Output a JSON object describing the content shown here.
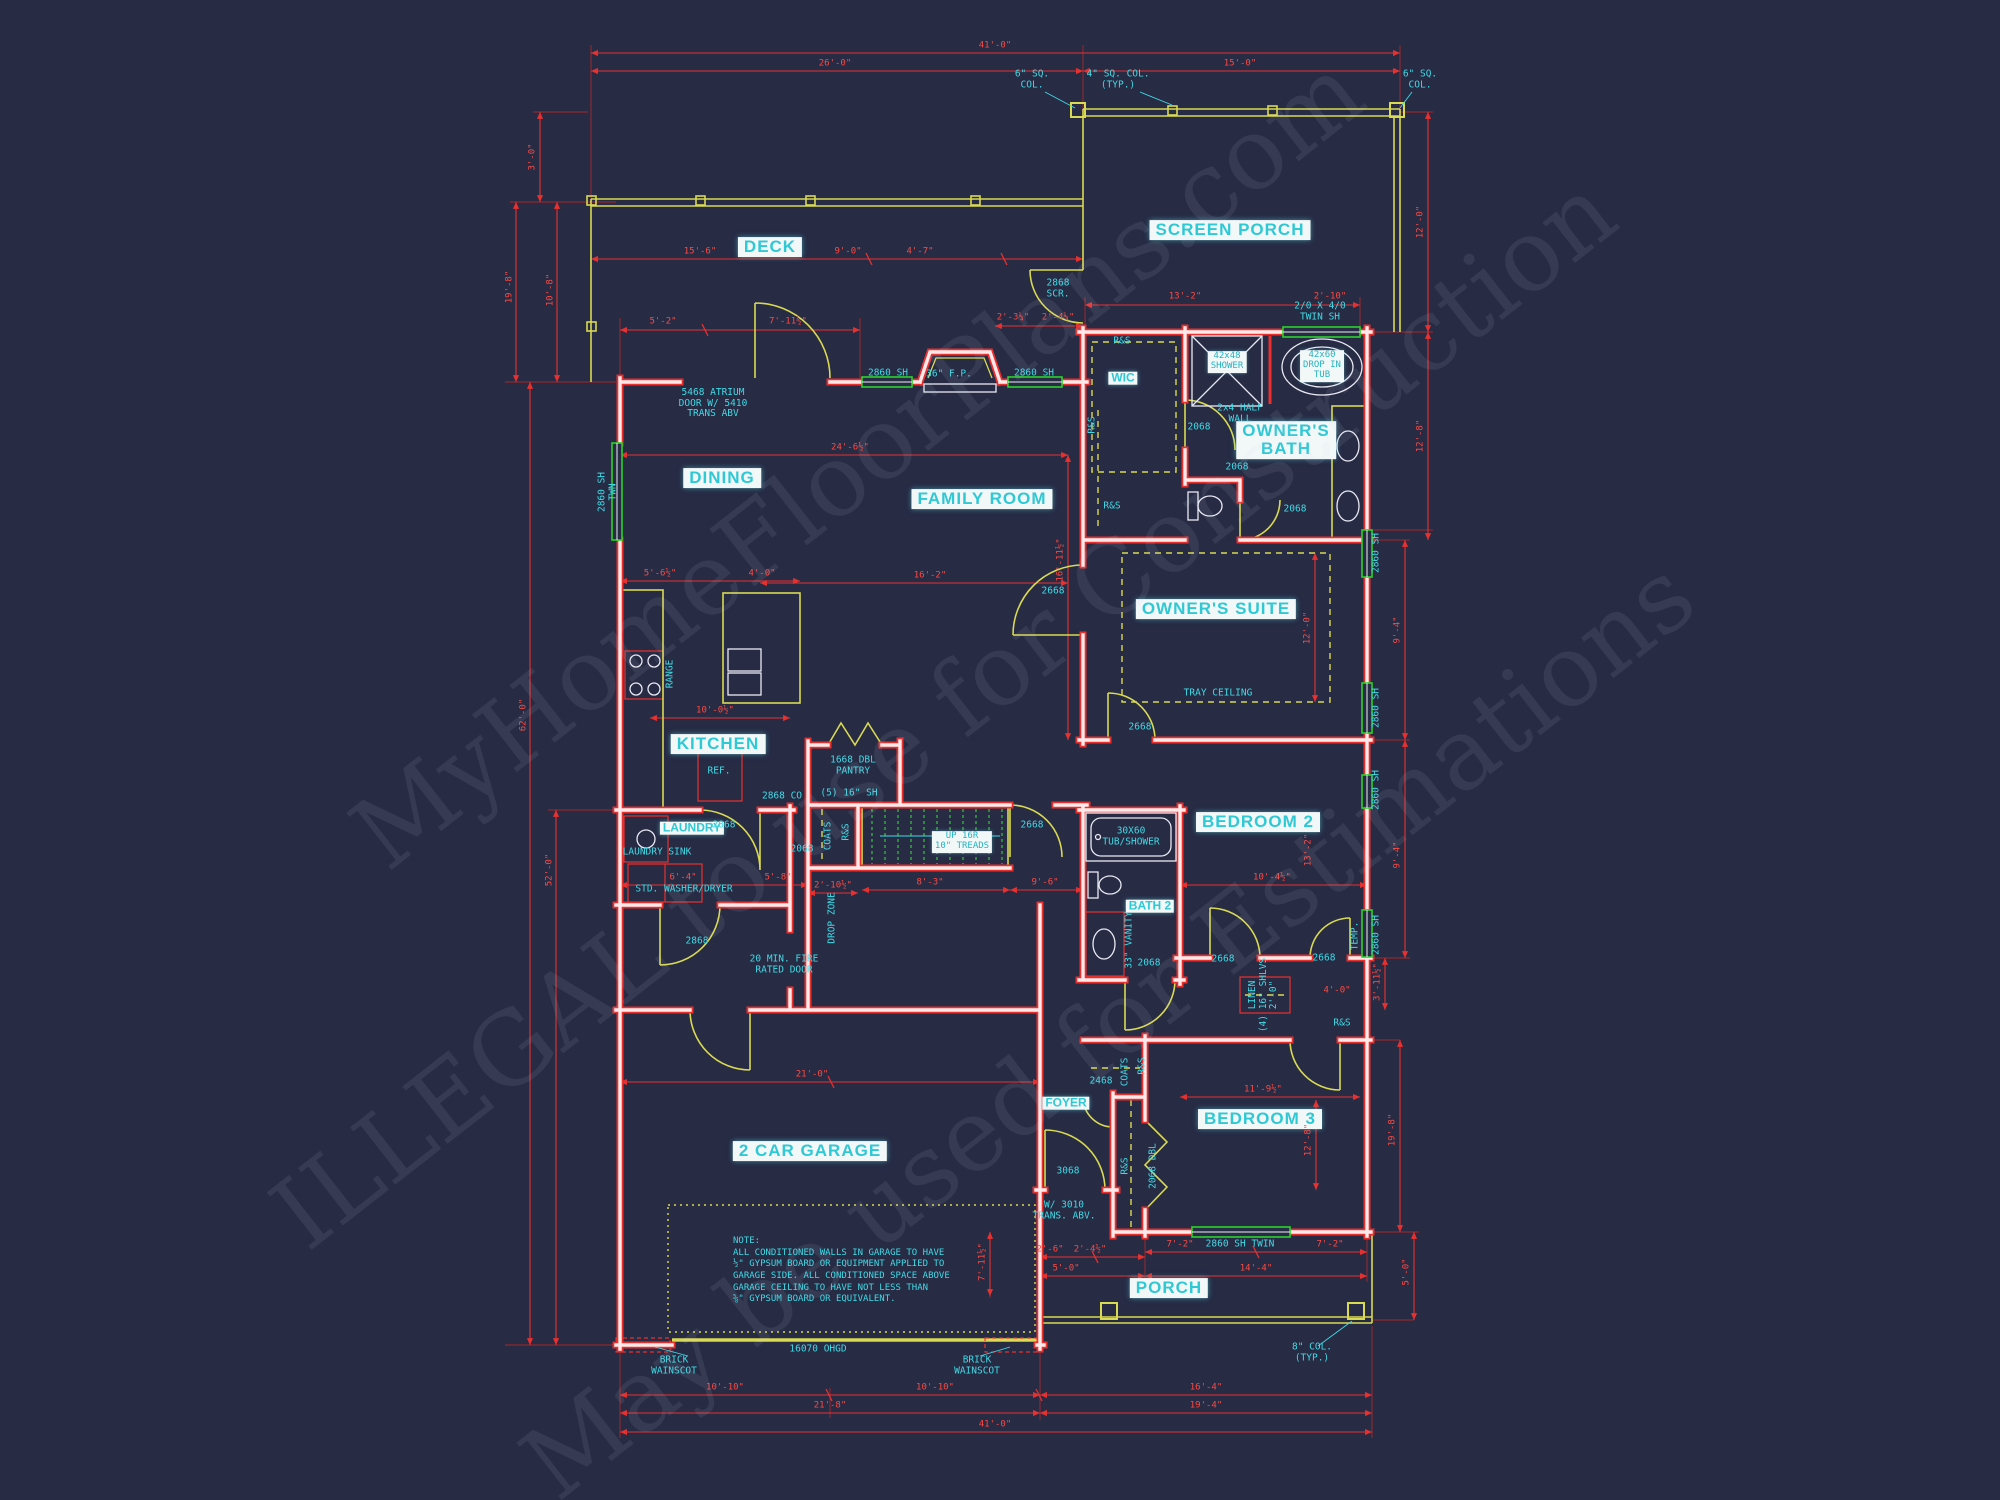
{
  "drawing": {
    "background": "#272b44",
    "colors": {
      "dimension_red": "#e8312f",
      "wall_fill": "#ffe9ea",
      "millwork_yellow": "#d9d952",
      "label_cyan": "#40dbe6",
      "window_green": "#29d32b",
      "fixture_white": "#e9e9f4"
    }
  },
  "watermark": {
    "lines": [
      {
        "t": "MyHomeFloorPlans.com",
        "x": 330,
        "y": 800
      },
      {
        "t": "ILLEGAL to use for Construction",
        "x": 250,
        "y": 1180
      },
      {
        "t": "May be used for Estimations",
        "x": 500,
        "y": 1430
      }
    ]
  },
  "rooms": [
    {
      "n": "room-label-deck",
      "label": "DECK",
      "x": 770,
      "y": 247
    },
    {
      "n": "room-label-screen-porch",
      "label": "SCREEN PORCH",
      "x": 1230,
      "y": 230
    },
    {
      "n": "room-label-dining",
      "label": "DINING",
      "x": 722,
      "y": 478
    },
    {
      "n": "room-label-family-room",
      "label": "FAMILY ROOM",
      "x": 982,
      "y": 499
    },
    {
      "n": "room-label-kitchen",
      "label": "KITCHEN",
      "x": 718,
      "y": 744
    },
    {
      "n": "room-label-laundry",
      "label": "LAUNDRY",
      "x": 692,
      "y": 828,
      "small": 1
    },
    {
      "n": "room-label-wic",
      "label": "WIC",
      "x": 1123,
      "y": 378,
      "small": 1
    },
    {
      "n": "room-label-owners-bath",
      "label": "OWNER'S\nBATH",
      "x": 1286,
      "y": 440
    },
    {
      "n": "room-label-owners-suite",
      "label": "OWNER'S SUITE",
      "x": 1216,
      "y": 609
    },
    {
      "n": "room-label-bedroom-2",
      "label": "BEDROOM 2",
      "x": 1258,
      "y": 822
    },
    {
      "n": "room-label-bath-2",
      "label": "BATH 2",
      "x": 1150,
      "y": 906,
      "small": 1
    },
    {
      "n": "room-label-foyer",
      "label": "FOYER",
      "x": 1066,
      "y": 1103,
      "small": 1
    },
    {
      "n": "room-label-bedroom-3",
      "label": "BEDROOM 3",
      "x": 1260,
      "y": 1119
    },
    {
      "n": "room-label-garage",
      "label": "2 CAR GARAGE",
      "x": 810,
      "y": 1151
    },
    {
      "n": "room-label-porch",
      "label": "PORCH",
      "x": 1169,
      "y": 1288
    }
  ],
  "boxes": [
    {
      "label": "42x48\nSHOWER",
      "x": 1227,
      "y": 362
    },
    {
      "label": "42x60\nDROP IN\nTUB",
      "x": 1322,
      "y": 366
    },
    {
      "label": "UP 16R\n10\" TREADS",
      "x": 962,
      "y": 842
    }
  ],
  "annotations": [
    {
      "t": "6\" SQ.\nCOL.",
      "x": 1032,
      "y": 80
    },
    {
      "t": "4\" SQ. COL.\n(TYP.)",
      "x": 1118,
      "y": 80
    },
    {
      "t": "6\" SQ.\nCOL.",
      "x": 1420,
      "y": 80
    },
    {
      "t": "2868\nSCR.",
      "x": 1058,
      "y": 289
    },
    {
      "t": "2/0 X 4/0\nTWIN SH",
      "x": 1320,
      "y": 312
    },
    {
      "t": "R&S",
      "x": 1122,
      "y": 342
    },
    {
      "t": "R&S",
      "x": 1093,
      "y": 425,
      "r": -90
    },
    {
      "t": "2x4 HALF\nWALL",
      "x": 1240,
      "y": 414
    },
    {
      "t": "2068",
      "x": 1199,
      "y": 428
    },
    {
      "t": "2068",
      "x": 1237,
      "y": 468
    },
    {
      "t": "2068",
      "x": 1295,
      "y": 510
    },
    {
      "t": "R&S",
      "x": 1112,
      "y": 507
    },
    {
      "t": "5468 ATRIUM\nDOOR W/ 5410\nTRANS ABV",
      "x": 713,
      "y": 404
    },
    {
      "t": "2860 SH",
      "x": 888,
      "y": 374
    },
    {
      "t": "36\" F.P.",
      "x": 949,
      "y": 375
    },
    {
      "t": "2860 SH",
      "x": 1034,
      "y": 374
    },
    {
      "t": "2860 SH\nTWN",
      "x": 608,
      "y": 492,
      "r": -90
    },
    {
      "t": "REF.",
      "x": 719,
      "y": 772
    },
    {
      "t": "RANGE",
      "x": 671,
      "y": 674,
      "r": -90
    },
    {
      "t": "1668 DBL\nPANTRY",
      "x": 853,
      "y": 766
    },
    {
      "t": "(5) 16\" SH",
      "x": 849,
      "y": 794
    },
    {
      "t": "2868 CO",
      "x": 782,
      "y": 797
    },
    {
      "t": "LAUNDRY SINK",
      "x": 657,
      "y": 853
    },
    {
      "t": "STD. WASHER/DRYER",
      "x": 684,
      "y": 890
    },
    {
      "t": "2868",
      "x": 724,
      "y": 826
    },
    {
      "t": "2868",
      "x": 697,
      "y": 942
    },
    {
      "t": "2668",
      "x": 1032,
      "y": 826
    },
    {
      "t": "COATS",
      "x": 829,
      "y": 836,
      "r": -90
    },
    {
      "t": "R&S",
      "x": 847,
      "y": 832,
      "r": -90
    },
    {
      "t": "2068",
      "x": 802,
      "y": 850
    },
    {
      "t": "DROP ZONE",
      "x": 833,
      "y": 918,
      "r": -90
    },
    {
      "t": "20 MIN. FIRE\nRATED DOOR",
      "x": 784,
      "y": 965
    },
    {
      "t": "TRAY CEILING",
      "x": 1218,
      "y": 694
    },
    {
      "t": "2668",
      "x": 1140,
      "y": 728
    },
    {
      "t": "2668",
      "x": 1053,
      "y": 592
    },
    {
      "t": "2860 SH",
      "x": 1377,
      "y": 553,
      "r": -90
    },
    {
      "t": "2860 SH",
      "x": 1377,
      "y": 708,
      "r": -90
    },
    {
      "t": "2860 SH",
      "x": 1377,
      "y": 790,
      "r": -90
    },
    {
      "t": "2860 SH",
      "x": 1377,
      "y": 935,
      "r": -90
    },
    {
      "t": "TEMP.",
      "x": 1356,
      "y": 936,
      "r": -90
    },
    {
      "t": "30X60\nTUB/SHOWER",
      "x": 1131,
      "y": 837
    },
    {
      "t": "33\" VANITY",
      "x": 1130,
      "y": 940,
      "r": -90
    },
    {
      "t": "2068",
      "x": 1149,
      "y": 964
    },
    {
      "t": "2668",
      "x": 1223,
      "y": 960
    },
    {
      "t": "2668",
      "x": 1324,
      "y": 959
    },
    {
      "t": "LINEN\n(4) 16\" SHLVS\n2'-0\"",
      "x": 1264,
      "y": 995,
      "r": -90
    },
    {
      "t": "R&S",
      "x": 1342,
      "y": 1024
    },
    {
      "t": "2468",
      "x": 1101,
      "y": 1082
    },
    {
      "t": "COATS",
      "x": 1126,
      "y": 1072,
      "r": -90
    },
    {
      "t": "R&S",
      "x": 1143,
      "y": 1066,
      "r": -90
    },
    {
      "t": "R&S",
      "x": 1126,
      "y": 1166,
      "r": -90
    },
    {
      "t": "2068 DBL",
      "x": 1154,
      "y": 1166,
      "r": -90
    },
    {
      "t": "3068",
      "x": 1068,
      "y": 1172
    },
    {
      "t": "W/ 3010\nTRANS. ABV.",
      "x": 1064,
      "y": 1211
    },
    {
      "t": "2860 SH TWIN",
      "x": 1240,
      "y": 1245
    },
    {
      "t": "16070 OHGD",
      "x": 818,
      "y": 1350
    },
    {
      "t": "BRICK\nWAINSCOT",
      "x": 674,
      "y": 1366
    },
    {
      "t": "BRICK\nWAINSCOT",
      "x": 977,
      "y": 1366
    },
    {
      "t": "8\" COL.\n(TYP.)",
      "x": 1312,
      "y": 1353
    }
  ],
  "note": {
    "x": 733,
    "y": 1236,
    "text": "NOTE:\nALL CONDITIONED WALLS IN GARAGE TO HAVE\n½\" GYPSUM BOARD OR EQUIPMENT APPLIED TO\nGARAGE SIDE. ALL CONDITIONED SPACE ABOVE\nGARAGE CEILING TO HAVE NOT LESS THAN\n⅝\" GYPSUM BOARD OR EQUIVALENT."
  },
  "dimensions": [
    {
      "t": "41'-0\"",
      "x": 995,
      "y": 46
    },
    {
      "t": "26'-0\"",
      "x": 835,
      "y": 64
    },
    {
      "t": "15'-0\"",
      "x": 1240,
      "y": 64
    },
    {
      "t": "15'-6\"",
      "x": 700,
      "y": 252
    },
    {
      "t": "9'-0\"",
      "x": 848,
      "y": 252
    },
    {
      "t": "4'-7\"",
      "x": 920,
      "y": 252
    },
    {
      "t": "3'-0\"",
      "x": 533,
      "y": 157,
      "r": -90
    },
    {
      "t": "19'-8\"",
      "x": 510,
      "y": 287,
      "r": -90
    },
    {
      "t": "10'-8\"",
      "x": 551,
      "y": 290,
      "r": -90
    },
    {
      "t": "62'-0\"",
      "x": 524,
      "y": 715,
      "r": -90
    },
    {
      "t": "52'-0\"",
      "x": 550,
      "y": 870,
      "r": -90
    },
    {
      "t": "5'-2\"",
      "x": 663,
      "y": 322
    },
    {
      "t": "7'-11½\"",
      "x": 788,
      "y": 322
    },
    {
      "t": "2'-3¼\"",
      "x": 1013,
      "y": 318
    },
    {
      "t": "2'-4¼\"",
      "x": 1058,
      "y": 318
    },
    {
      "t": "13'-2\"",
      "x": 1185,
      "y": 297
    },
    {
      "t": "2'-10\"",
      "x": 1330,
      "y": 297
    },
    {
      "t": "24'-6½\"",
      "x": 850,
      "y": 448
    },
    {
      "t": "16'-2\"",
      "x": 930,
      "y": 576
    },
    {
      "t": "16'-11½\"",
      "x": 1061,
      "y": 560,
      "r": -90
    },
    {
      "t": "5'-6½\"",
      "x": 660,
      "y": 574
    },
    {
      "t": "4'-0\"",
      "x": 762,
      "y": 574
    },
    {
      "t": "10'-0½\"",
      "x": 715,
      "y": 711
    },
    {
      "t": "6'-4\"",
      "x": 683,
      "y": 878
    },
    {
      "t": "5'-8\"",
      "x": 778,
      "y": 878
    },
    {
      "t": "2'-10½\"",
      "x": 833,
      "y": 886
    },
    {
      "t": "8'-3\"",
      "x": 930,
      "y": 883
    },
    {
      "t": "9'-6\"",
      "x": 1045,
      "y": 883
    },
    {
      "t": "12'-0\"",
      "x": 1308,
      "y": 628,
      "r": -90
    },
    {
      "t": "9'-4\"",
      "x": 1398,
      "y": 630,
      "r": -90
    },
    {
      "t": "12'-0\"",
      "x": 1421,
      "y": 222,
      "r": -90
    },
    {
      "t": "12'-8\"",
      "x": 1421,
      "y": 436,
      "r": -90
    },
    {
      "t": "10'-4½\"",
      "x": 1272,
      "y": 878
    },
    {
      "t": "13'-2\"",
      "x": 1309,
      "y": 850,
      "r": -90
    },
    {
      "t": "9'-4\"",
      "x": 1398,
      "y": 855,
      "r": -90
    },
    {
      "t": "3'-11½\"",
      "x": 1378,
      "y": 982,
      "r": -90
    },
    {
      "t": "4'-0\"",
      "x": 1337,
      "y": 991
    },
    {
      "t": "11'-9½\"",
      "x": 1263,
      "y": 1090
    },
    {
      "t": "12'-8\"",
      "x": 1309,
      "y": 1140,
      "r": -90
    },
    {
      "t": "19'-8\"",
      "x": 1393,
      "y": 1130,
      "r": -90
    },
    {
      "t": "5'-0\"",
      "x": 1407,
      "y": 1272,
      "r": -90
    },
    {
      "t": "21'-0\"",
      "x": 812,
      "y": 1075
    },
    {
      "t": "7'-11½\"",
      "x": 983,
      "y": 1262,
      "r": -90
    },
    {
      "t": "2'-6\"",
      "x": 1050,
      "y": 1250
    },
    {
      "t": "2'-4½\"",
      "x": 1090,
      "y": 1250
    },
    {
      "t": "5'-0\"",
      "x": 1066,
      "y": 1269
    },
    {
      "t": "7'-2\"",
      "x": 1180,
      "y": 1245
    },
    {
      "t": "7'-2\"",
      "x": 1330,
      "y": 1245
    },
    {
      "t": "14'-4\"",
      "x": 1256,
      "y": 1269
    },
    {
      "t": "10'-10\"",
      "x": 725,
      "y": 1388
    },
    {
      "t": "10'-10\"",
      "x": 935,
      "y": 1388
    },
    {
      "t": "16'-4\"",
      "x": 1206,
      "y": 1388
    },
    {
      "t": "21'-8\"",
      "x": 830,
      "y": 1406
    },
    {
      "t": "19'-4\"",
      "x": 1206,
      "y": 1406
    },
    {
      "t": "41'-0\"",
      "x": 995,
      "y": 1425
    }
  ]
}
